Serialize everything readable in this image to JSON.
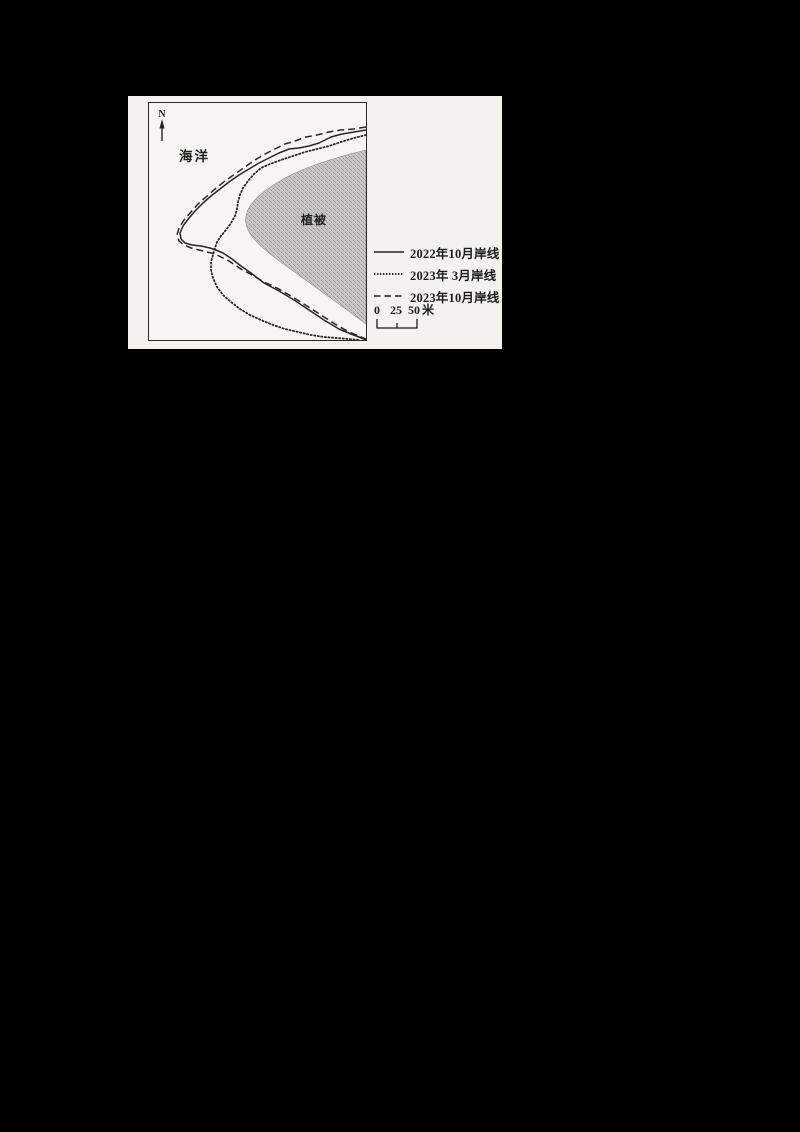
{
  "figure": {
    "type": "coastline-change-map",
    "north_label": "N",
    "ocean_label": "海洋",
    "vegetation_label": "植被"
  },
  "legend": {
    "items": [
      {
        "line_style": "solid",
        "label": "2022年10月岸线"
      },
      {
        "line_style": "dotted",
        "label": "2023年 3月岸线"
      },
      {
        "line_style": "dashed",
        "label": "2023年10月岸线"
      }
    ]
  },
  "scale_bar": {
    "tick_labels": [
      "0",
      "25",
      "50"
    ],
    "unit_label": "米"
  },
  "colors": {
    "page_background": "#000000",
    "sheet_background": "#f3f2ee",
    "ink": "#262626",
    "vegetation_base": "#c8c7c3",
    "vegetation_speckle": "#90908c"
  }
}
